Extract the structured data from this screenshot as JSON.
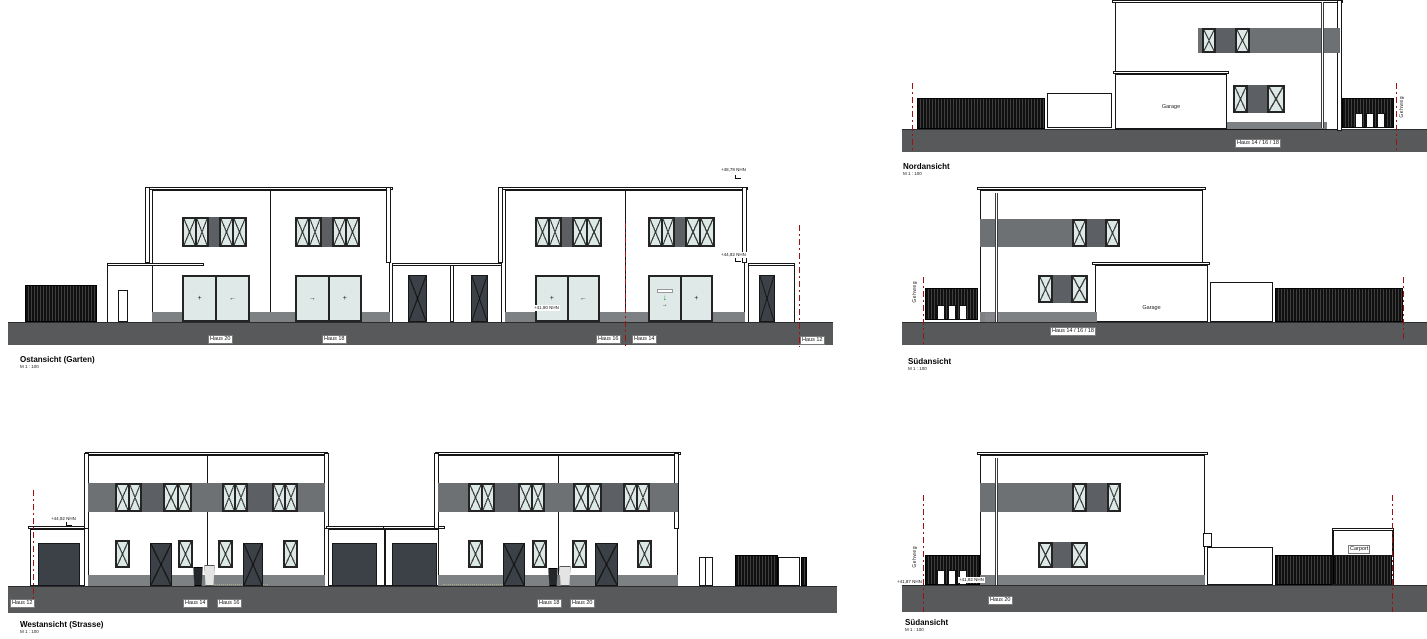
{
  "drawing": {
    "views": {
      "ost": {
        "title": "Ostansicht (Garten)",
        "scale": "M 1 : 100",
        "houses": {
          "h20": "Haus 20",
          "h18": "Haus 18",
          "h16": "Haus 16",
          "h14": "Haus 14",
          "h12": "Haus 12"
        },
        "levels": {
          "parapet": "+48,78 NHN",
          "roof": "+44,92 NHN",
          "floor": "+41,90 NHN"
        }
      },
      "west": {
        "title": "Westansicht (Strasse)",
        "scale": "M 1 : 100",
        "houses": {
          "h12": "Haus 12",
          "h14": "Haus 14",
          "h16": "Haus 16",
          "h18": "Haus 18",
          "h20": "Haus 20"
        },
        "levels": {
          "roof": "+44,92 NHN"
        }
      },
      "nord": {
        "title": "Nordansicht",
        "scale": "M 1 : 100",
        "house_label": "Haus 14 / 16 / 18",
        "garage_label": "Garage",
        "sidewalk_label": "Gehweg"
      },
      "sued_mitte": {
        "title": "Südansicht",
        "scale": "M 1 : 100",
        "house_label": "Haus 14 / 16 / 18",
        "garage_label": "Garage",
        "sidewalk_label": "Gehweg"
      },
      "sued_unten": {
        "title": "Südansicht",
        "scale": "M 1 : 100",
        "house_label": "Haus 20",
        "carport_label": "Carport",
        "sidewalk_label": "Gehweg",
        "levels": {
          "ground_left": "+41,87 NHN",
          "ground_right": "+41,92 NHN"
        }
      }
    },
    "door_symbols": {
      "fixed": "+",
      "slide_left": "←",
      "slide_right": "→",
      "entrance_arrow": "↓"
    }
  }
}
